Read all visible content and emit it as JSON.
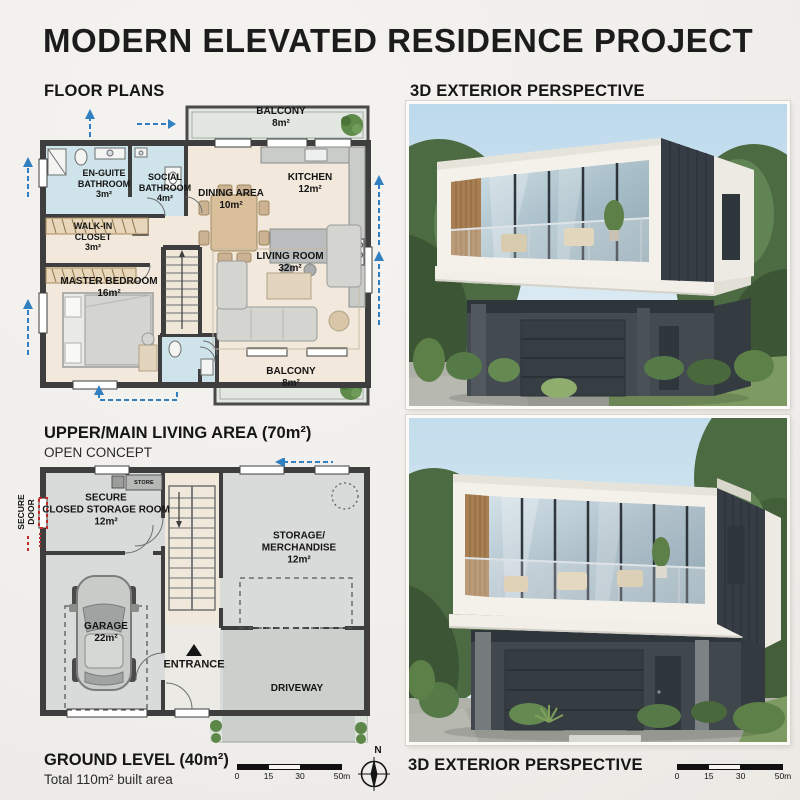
{
  "page": {
    "title": "MODERN ELEVATED RESIDENCE PROJECT"
  },
  "headers": {
    "floor_plans": "FLOOR PLANS",
    "exterior_top": "3D EXTERIOR PERSPECTIVE",
    "exterior_bottom": "3D EXTERIOR PERSPECTIVE"
  },
  "upper_plan": {
    "caption": "UPPER/MAIN LIVING AREA (70m²)",
    "subcaption": "OPEN CONCEPT",
    "rooms": {
      "balcony_top": {
        "name": "BALCONY",
        "area": "8m²"
      },
      "ensuite_bathroom": {
        "name": "EN-GUITE\nBATHROOM",
        "area": "3m²"
      },
      "social_bathroom": {
        "name": "SOCIAL\nBATHROOM",
        "area": "4m²"
      },
      "dining_area": {
        "name": "DINING AREA",
        "area": "10m²"
      },
      "kitchen": {
        "name": "KITCHEN",
        "area": "12m²"
      },
      "walk_in_closet": {
        "name": "WALK-IN\nCLOSET",
        "area": "3m²"
      },
      "master_bedroom": {
        "name": "MASTER BEDROOM",
        "area": "16m²"
      },
      "living_room": {
        "name": "LIVING ROOM",
        "area": "32m²"
      },
      "balcony_bottom": {
        "name": "BALCONY",
        "area": "8m²"
      }
    }
  },
  "ground_plan": {
    "caption": "GROUND LEVEL (40m²)",
    "subcaption": "Total 110m² built area",
    "rooms": {
      "secure_storage": {
        "name": "SECURE\nCLOSED STORAGE ROOM",
        "area": "12m²"
      },
      "store_box": {
        "name": "STORE"
      },
      "storage_merchandise": {
        "name": "STORAGE/\nMERCHANDISE",
        "area": "12m²"
      },
      "garage": {
        "name": "GARAGE",
        "area": "22m²"
      },
      "entrance": {
        "name": "ENTRANCE"
      },
      "driveway": {
        "name": "DRIVEWAY"
      },
      "secure_door": {
        "name": "SECURE\nDOOR"
      }
    }
  },
  "scale_bar": {
    "ticks": [
      "0",
      "15",
      "30",
      "50m"
    ]
  },
  "compass": {
    "label": "N"
  },
  "colors": {
    "background": "#f1efec",
    "ink": "#1c1c1c",
    "wall_dark": "#3e3e3e",
    "arrow_blue": "#2f7fc1",
    "secure_red": "#c62828",
    "bathroom_blue": "#cfe4ea",
    "floor_beige": "#f2e9dc",
    "ground_gray": "#d9dbda",
    "balcony_gray": "#e4e7e2",
    "plant_green": "#5c8748",
    "cladding_dark": "#363d44",
    "facade_white": "#f3f1ea",
    "wood_accent": "#a87e52"
  }
}
